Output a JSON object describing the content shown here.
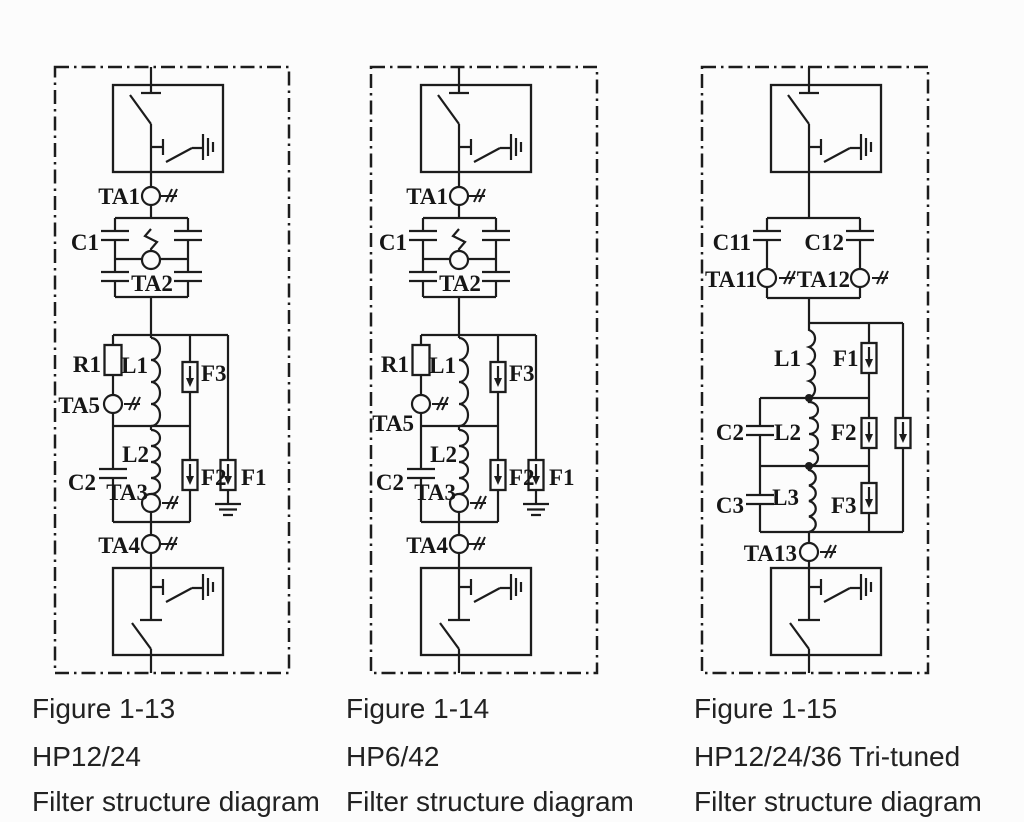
{
  "page": {
    "background": "#fcfcfc",
    "ink": "#1c1c1c",
    "type": "scanned filter schematic page"
  },
  "diagrams": [
    {
      "figure": "Figure 1-13",
      "model": "HP12/24",
      "caption": "Filter structure diagram",
      "labels": {
        "ta1": "TA1",
        "c1": "C1",
        "ta2": "TA2",
        "r1": "R1",
        "l1": "L1",
        "f3": "F3",
        "ta5": "TA5",
        "l2": "L2",
        "c2": "C2",
        "ta3": "TA3",
        "f2": "F2",
        "f1": "F1",
        "ta4": "TA4"
      }
    },
    {
      "figure": "Figure 1-14",
      "model": "HP6/42",
      "caption": "Filter structure diagram",
      "labels": {
        "ta1": "TA1",
        "c1": "C1",
        "ta2": "TA2",
        "r1": "R1",
        "l1": "L1",
        "f3": "F3",
        "ta5": "TA5",
        "l2": "L2",
        "c2": "C2",
        "ta3": "TA3",
        "f2": "F2",
        "f1": "F1",
        "ta4": "TA4"
      }
    },
    {
      "figure": "Figure 1-15",
      "model": "HP12/24/36 Tri-tuned",
      "caption": "Filter structure diagram",
      "labels": {
        "c11": "C11",
        "c12": "C12",
        "ta11": "TA11",
        "ta12": "TA12",
        "l1": "L1",
        "f1": "F1",
        "c2": "C2",
        "l2": "L2",
        "f2": "F2",
        "c3": "C3",
        "l3": "L3",
        "f3": "F3",
        "ta13": "TA13"
      }
    }
  ]
}
